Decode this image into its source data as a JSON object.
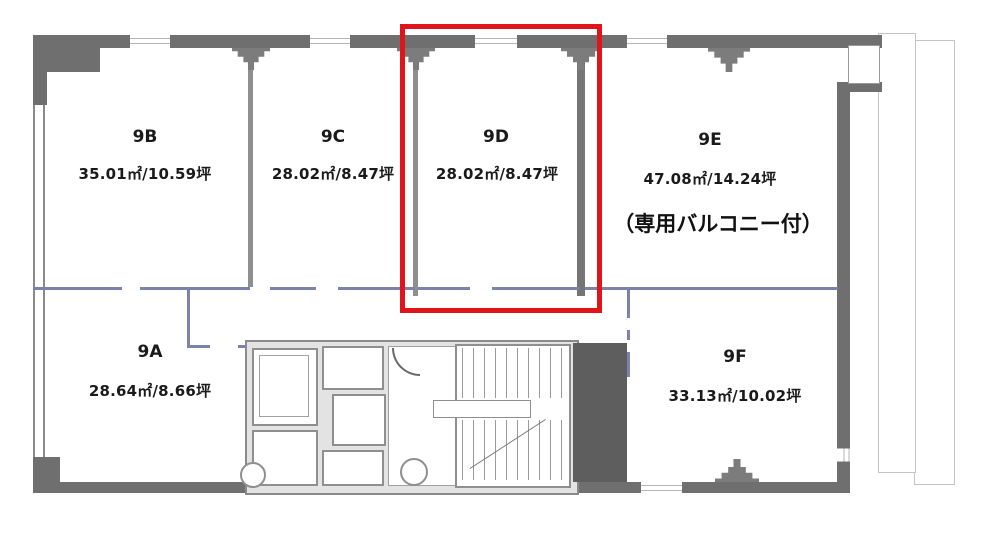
{
  "floorplan": {
    "floor": "9",
    "rooms": [
      {
        "id": "9A",
        "area": "28.64㎡/8.66坪"
      },
      {
        "id": "9B",
        "area": "35.01㎡/10.59坪"
      },
      {
        "id": "9C",
        "area": "28.02㎡/8.47坪"
      },
      {
        "id": "9D",
        "area": "28.02㎡/8.47坪"
      },
      {
        "id": "9E",
        "area": "47.08㎡/14.24坪",
        "note": "（専用バルコニー付）"
      },
      {
        "id": "9F",
        "area": "33.13㎡/10.02坪"
      }
    ],
    "highlighted_room": "9D",
    "colors": {
      "highlight": "#e0151b",
      "wall": "#6f6f6f",
      "corridor_line": "#7b82ac"
    }
  }
}
